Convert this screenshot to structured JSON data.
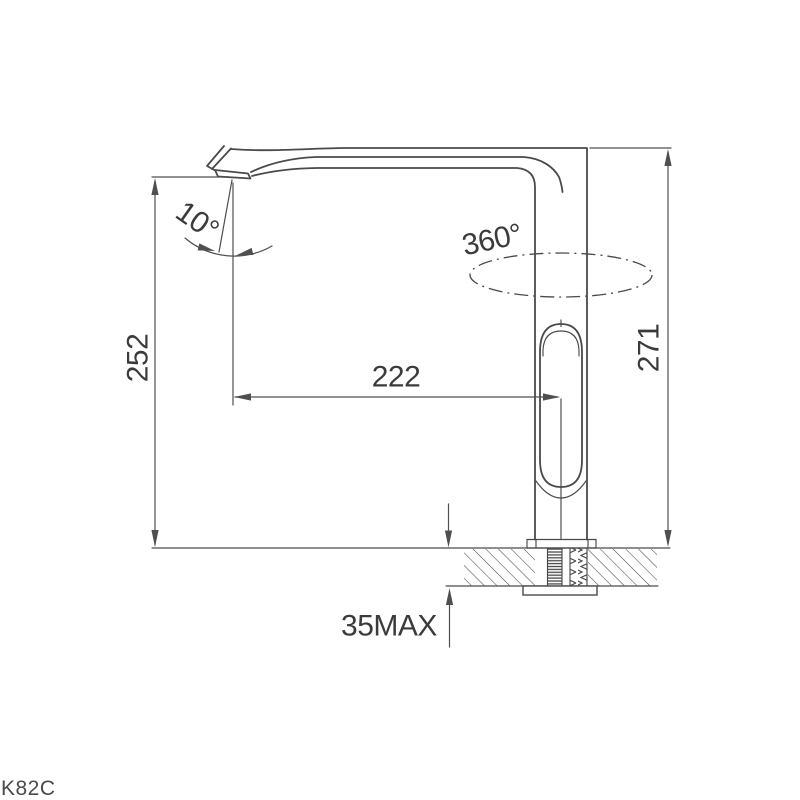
{
  "product": {
    "model_code": "K82C"
  },
  "drawing": {
    "kind": "technical-dimension-drawing",
    "subject": "kitchen faucet side elevation with countertop mounting section",
    "colors": {
      "line": "#4a4a4a",
      "text": "#3b3b3b",
      "background": "#ffffff"
    },
    "dimensions": {
      "spout_height": "252",
      "spout_reach": "222",
      "overall_height": "271",
      "deck_thickness_max": "35MAX",
      "spout_tilt_angle": "10°",
      "swivel_range": "360°"
    }
  }
}
